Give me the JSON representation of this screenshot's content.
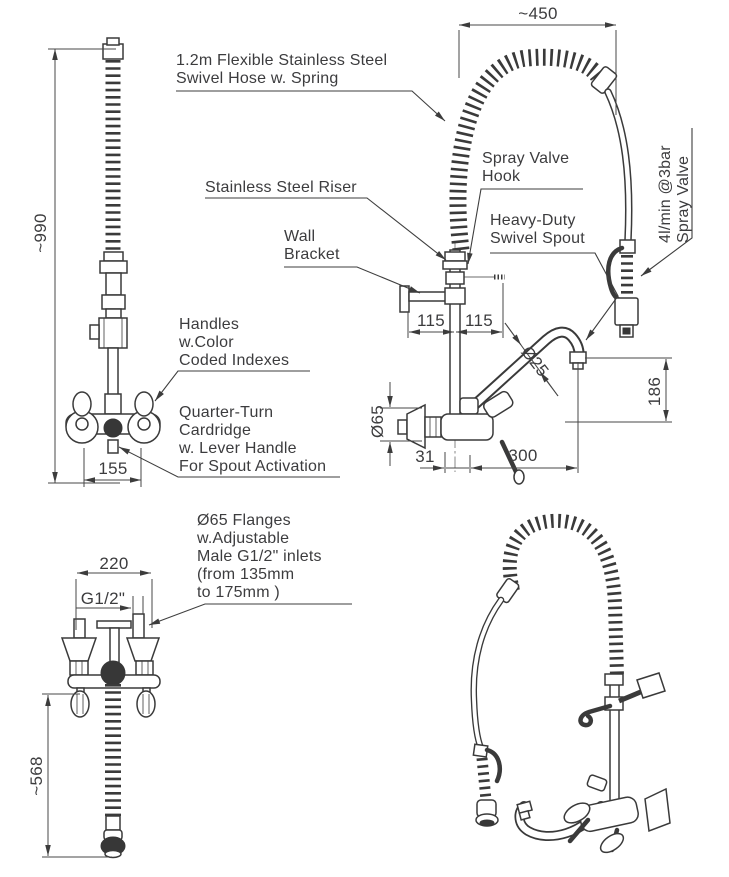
{
  "colors": {
    "line": "#3a3a3a",
    "background": "#ffffff"
  },
  "callouts": {
    "hose": "1.2m Flexible Stainless Steel\nSwivel Hose w. Spring",
    "riser": "Stainless Steel Riser",
    "wall_bracket": "Wall\nBracket",
    "spray_valve_hook": "Spray Valve\nHook",
    "swivel_spout": "Heavy-Duty\nSwivel Spout",
    "spray_valve": "4l/min @3bar\nSpray Valve",
    "handles": "Handles\nw.Color\nCoded Indexes",
    "cartridge": "Quarter-Turn\nCardridge\nw. Lever Handle\nFor Spout Activation",
    "flanges": "Ø65 Flanges\nw.Adjustable\nMale G1/2\" inlets\n(from 135mm\nto 175mm )"
  },
  "dims": {
    "d450": "~450",
    "d990": "~990",
    "d155": "155",
    "d115a": "115",
    "d115b": "115",
    "d25": "Ø25",
    "d65": "Ø65",
    "d186": "186",
    "d31": "31",
    "d300": "300",
    "d220": "220",
    "dG12": "G1/2\"",
    "d568": "~568"
  }
}
